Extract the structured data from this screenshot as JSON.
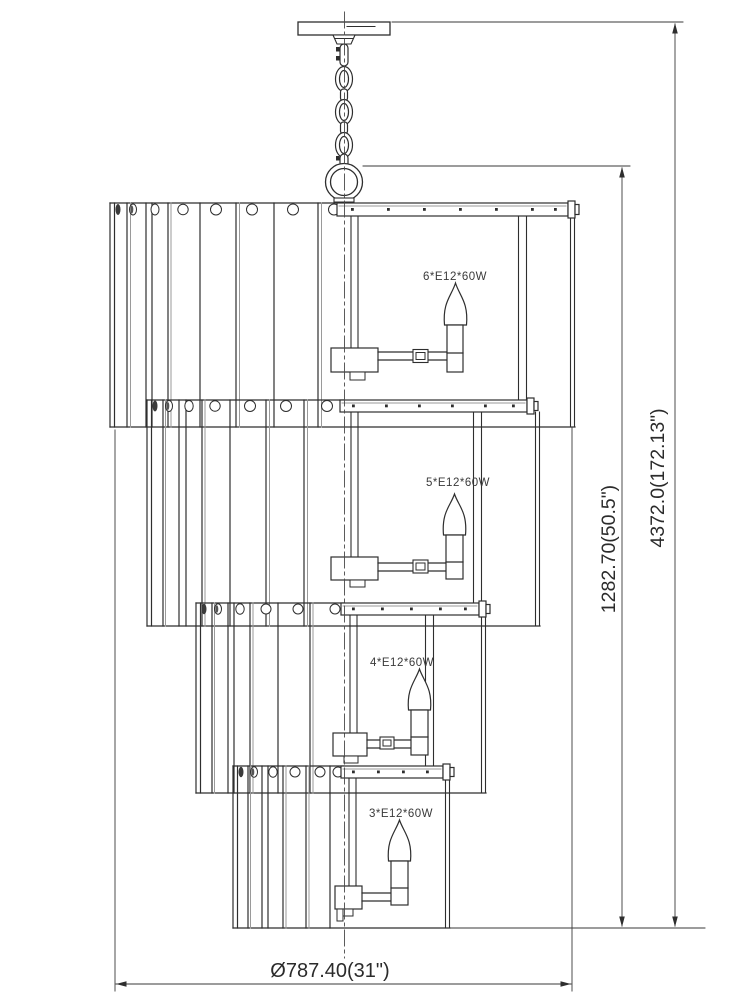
{
  "drawing": {
    "kind": "chandelier-technical-elevation",
    "background": "#ffffff",
    "line_color": "#2e2e2e",
    "secondary_line_color": "#999999"
  },
  "lamp_labels": {
    "tier_1": "6*E12*60W",
    "tier_2": "5*E12*60W",
    "tier_3": "4*E12*60W",
    "tier_4": "3*E12*60W"
  },
  "dimensions": {
    "fixture_height": "1282.70(50.5\")",
    "overall_height": "4372.0(172.13\")",
    "diameter": "Ø787.40(31\")"
  }
}
